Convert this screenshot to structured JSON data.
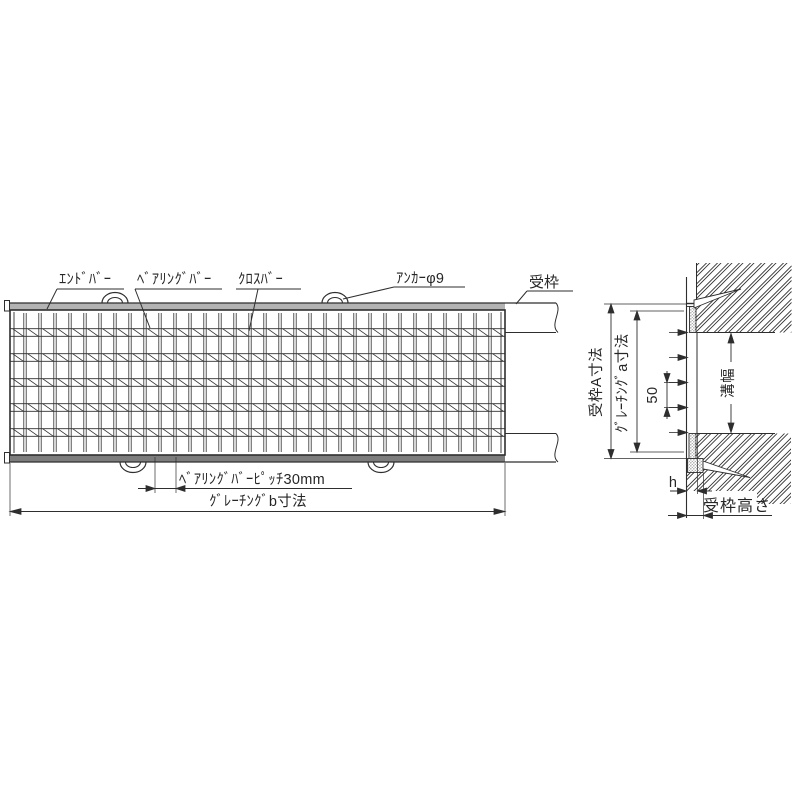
{
  "drawing_title": "grating-and-frame-installation-diagram",
  "plan_view": {
    "labels": {
      "end_bar": "ｴﾝﾄﾞﾊﾞｰ",
      "bearing_bar": "ﾍﾞｱﾘﾝｸﾞﾊﾞｰ",
      "cross_bar": "ｸﾛｽﾊﾞｰ",
      "anchor": "ｱﾝｶｰφ9",
      "frame": "受枠"
    },
    "dimensions": {
      "bearing_bar_pitch": "ﾍﾞｱﾘﾝｸﾞﾊﾞｰﾋﾟｯﾁ30mm",
      "grating_width_b": "ｸﾞﾚｰﾁﾝｸﾞb寸法"
    }
  },
  "section_view": {
    "dimensions": {
      "frame_outer_a": "受枠A寸法",
      "grating_span_a": "ｸﾞﾚｰﾁﾝｸﾞa寸法",
      "cross_bar_pitch": "50",
      "groove_width": "溝幅",
      "grating_height": "h",
      "frame_height": "受枠高さ"
    }
  },
  "colors": {
    "line": "#2e2e2e",
    "frame_top_fill": "#b3b3b3",
    "frame_bottom_fill": "#7d7d7d"
  }
}
